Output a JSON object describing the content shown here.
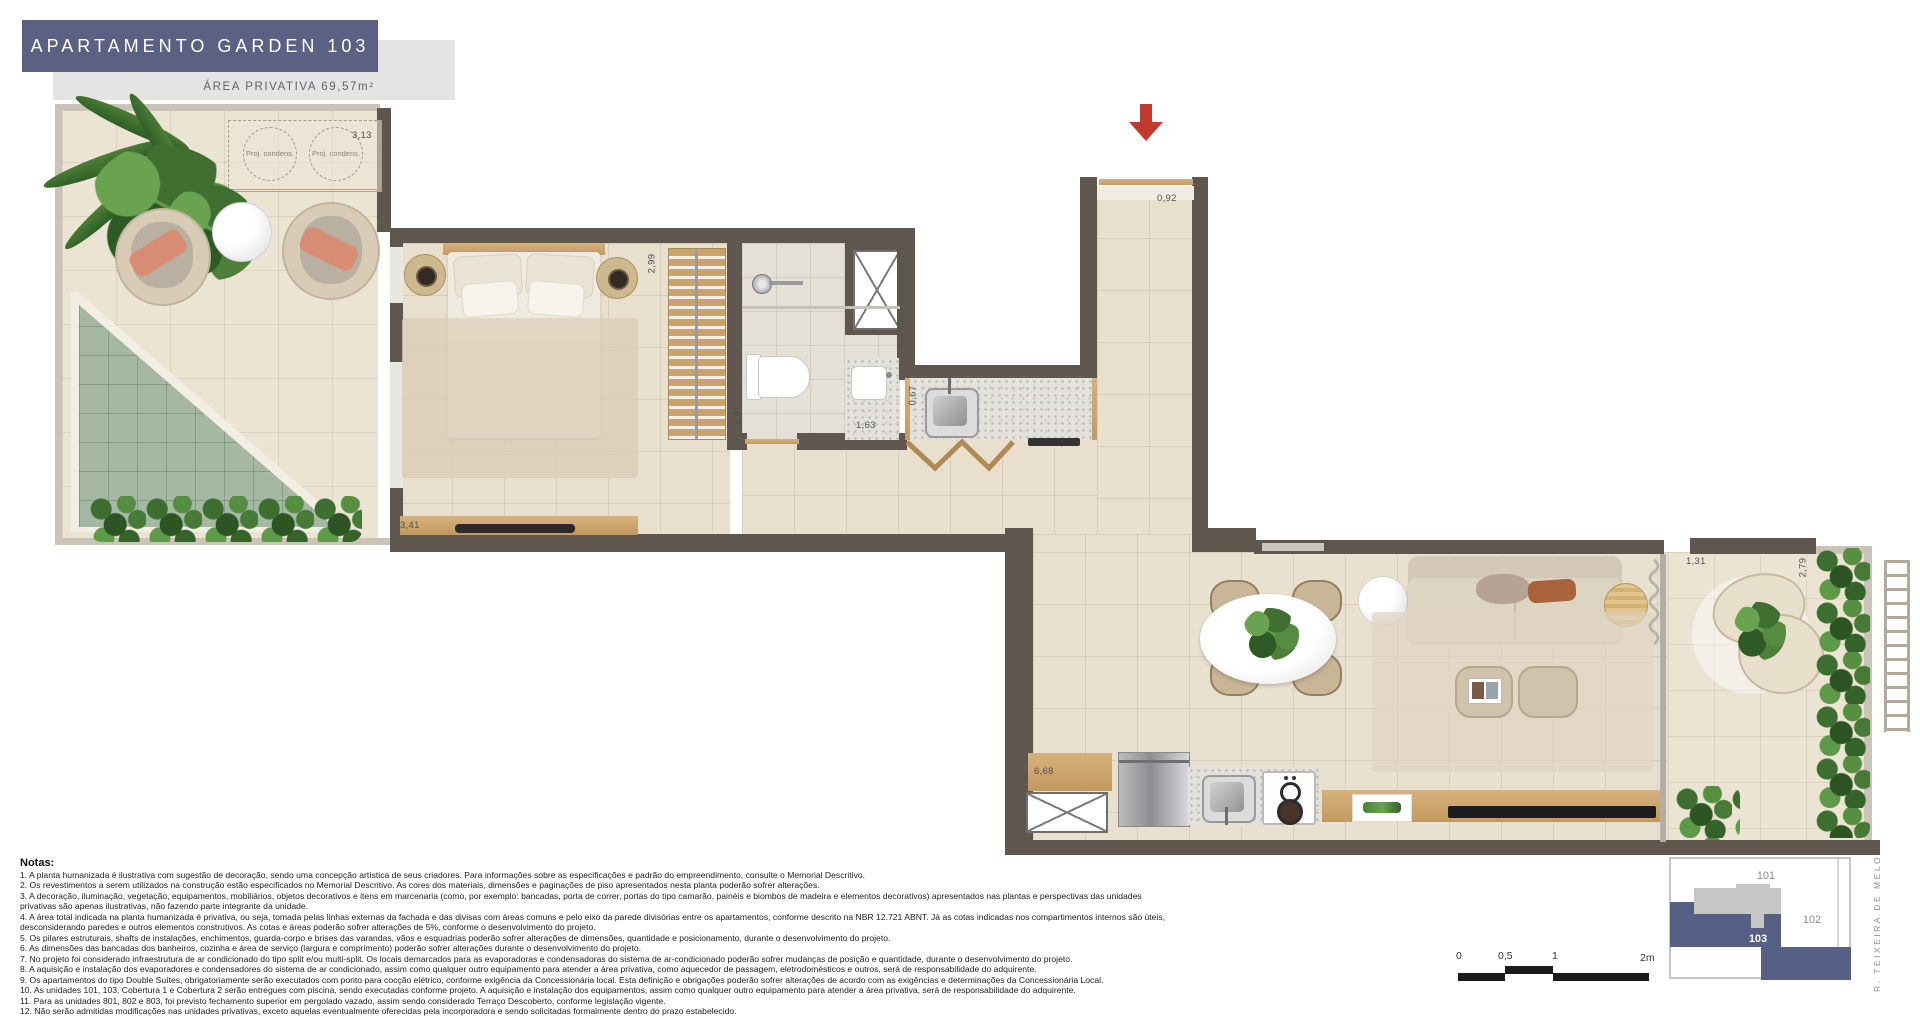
{
  "header": {
    "title": "APARTAMENTO GARDEN 103",
    "subtitle": "ÁREA PRIVATIVA 69,57m²",
    "banner_color": "#5a6183"
  },
  "plan": {
    "condensers": {
      "label": "Proj. condens."
    },
    "dims": {
      "garden_top": "3,13",
      "garden_side": "4,17",
      "bedroom": "3,41",
      "wardrobe": "2,99",
      "bath": "1,91",
      "lavabo": "1,63",
      "counter": "0,67",
      "entry": "0,92",
      "hall": "2,86",
      "living": "6,68",
      "terrace_door": "1,31",
      "terrace_side": "2,79"
    }
  },
  "notes": {
    "title": "Notas:",
    "items": [
      "1. A planta humanizada é ilustrativa com sugestão de decoração, sendo uma concepção artística de seus criadores. Para informações sobre as especificações e padrão do empreendimento, consulte o Memorial Descritivo.",
      "2. Os revestimentos a serem utilizados na construção estão especificados no Memorial Descritivo. As cores dos materiais, dimensões e paginações de piso apresentados nesta planta poderão sofrer alterações.",
      "3. A decoração, iluminação, vegetação, equipamentos, mobiliários, objetos decorativos e itens em marcenaria (como, por exemplo: bancadas, porta de correr, portas do tipo camarão, painéis e biombos de madeira e elementos decorativos) apresentados nas plantas e perspectivas das unidades privativas são apenas ilustrativas, não fazendo parte integrante da unidade.",
      "4. A área total indicada na planta humanizada é privativa, ou seja, tomada pelas linhas externas da fachada e das divisas com áreas comuns e pelo eixo da parede divisórias entre os apartamentos, conforme descrito na NBR 12.721 ABNT. Já as cotas indicadas nos compartimentos internos são úteis, desconsiderando paredes e outros elementos construtivos. As cotas e áreas poderão sofrer alterações de 5%, conforme o desenvolvimento do projeto.",
      "5. Os pilares estruturais, shafts de instalações, enchimentos, guarda-corpo e brises das varandas, vãos e esquadrias poderão sofrer alterações de dimensões, quantidade e posicionamento, durante o desenvolvimento do projeto.",
      "6. As dimensões das bancadas dos banheiros, cozinha e área de serviço (largura e comprimento) poderão sofrer alterações durante o desenvolvimento do projeto.",
      "7. No projeto foi considerado infraestrutura de ar condicionado do tipo split e/ou multi-split. Os locais demarcados para as evaporadoras e condensadoras do sistema de ar-condicionado poderão sofrer mudanças de posição e quantidade, durante o desenvolvimento do projeto.",
      "8. A aquisição e instalação dos evaporadores e condensadores do sistema de ar condicionado, assim como qualquer outro equipamento para atender a área privativa, como aquecedor de passagem, eletrodomésticos e outros, será de responsabilidade do adquirente.",
      "9. Os apartamentos do tipo Double Suítes, obrigatoriamente serão executados com ponto para cocção elétrico, conforme exigência da Concessionária local. Esta definição e obrigações poderão sofrer alterações de acordo com as exigências e determinações da Concessionária Local.",
      "10. As unidades 101, 103, Cobertura 1 e Cobertura 2 serão entregues com piscina, sendo executadas conforme projeto. A aquisição e instalação dos equipamentos, assim como qualquer outro equipamento para atender a área privativa, será de responsabilidade do adquirente.",
      "11. Para as unidades 801, 802 e 803, foi previsto fechamento superior em pergolado vazado, assim sendo considerado Terraço Descoberto, conforme legislação vigente.",
      "12. Não serão admitidas modificações nas unidades privativas, exceto aquelas eventualmente oferecidas pela incorporadora e sendo solicitadas formalmente dentro do prazo estabelecido."
    ]
  },
  "keyplan": {
    "unit_101": "101",
    "unit_102": "102",
    "unit_103": "103",
    "street": "R. TEIXEIRA DE MELO",
    "highlight_color": "#566084"
  },
  "scalebar": {
    "t0": "0",
    "t05": "0,5",
    "t1": "1",
    "t2": "2m"
  }
}
